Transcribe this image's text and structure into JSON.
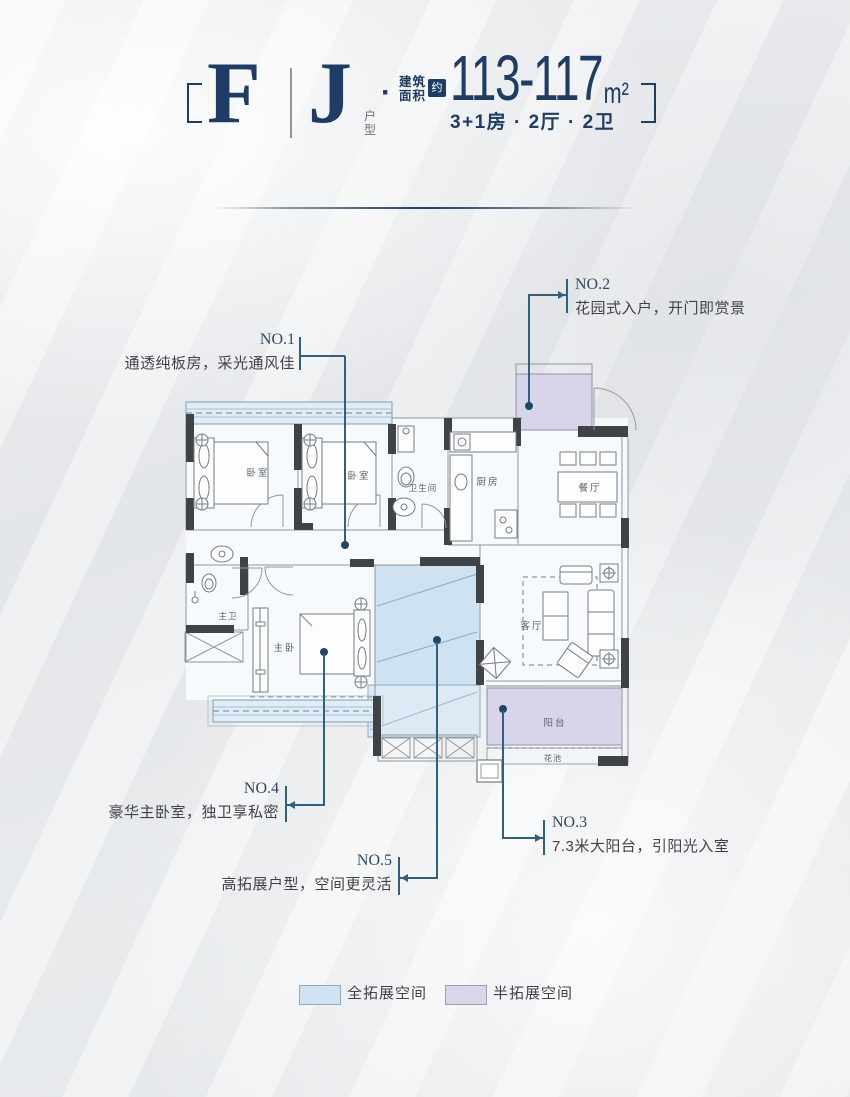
{
  "header": {
    "type_letters": [
      "F",
      "J"
    ],
    "type_suffix": "户型",
    "separator_dot": "·",
    "area_label_lines": [
      "建筑",
      "面积"
    ],
    "area_approx": "约",
    "area_value": "113-117",
    "area_unit": "m²",
    "config": "3+1房 · 2厅 · 2卫"
  },
  "plan": {
    "rooms": {
      "bedroom1": "卧室",
      "bedroom2": "卧室",
      "bathroom": "卫生间",
      "kitchen": "厨房",
      "dining": "餐厅",
      "master_bath": "主卫",
      "master_bedroom": "主卧",
      "living": "客厅",
      "balcony": "阳台",
      "flower_bed": "花池"
    },
    "annotations": [
      {
        "no": "NO.1",
        "text": "通透纯板房，采光通风佳"
      },
      {
        "no": "NO.2",
        "text": "花园式入户，开门即赏景"
      },
      {
        "no": "NO.3",
        "text": "7.3米大阳台，引阳光入室"
      },
      {
        "no": "NO.4",
        "text": "豪华主卧室，独卫享私密"
      },
      {
        "no": "NO.5",
        "text": "高拓展户型，空间更灵活"
      }
    ]
  },
  "legend": {
    "items": [
      {
        "label": "全拓展空间",
        "color": "#cfe3f2"
      },
      {
        "label": "半拓展空间",
        "color": "#d9d6ea"
      }
    ]
  },
  "colors": {
    "accent_navy": "#1d3c66",
    "leader_line": "#30607e",
    "wall_dark": "#3f4347",
    "full_expand_fill": "#cfe3f2",
    "half_expand_fill": "#d9d6ea"
  }
}
